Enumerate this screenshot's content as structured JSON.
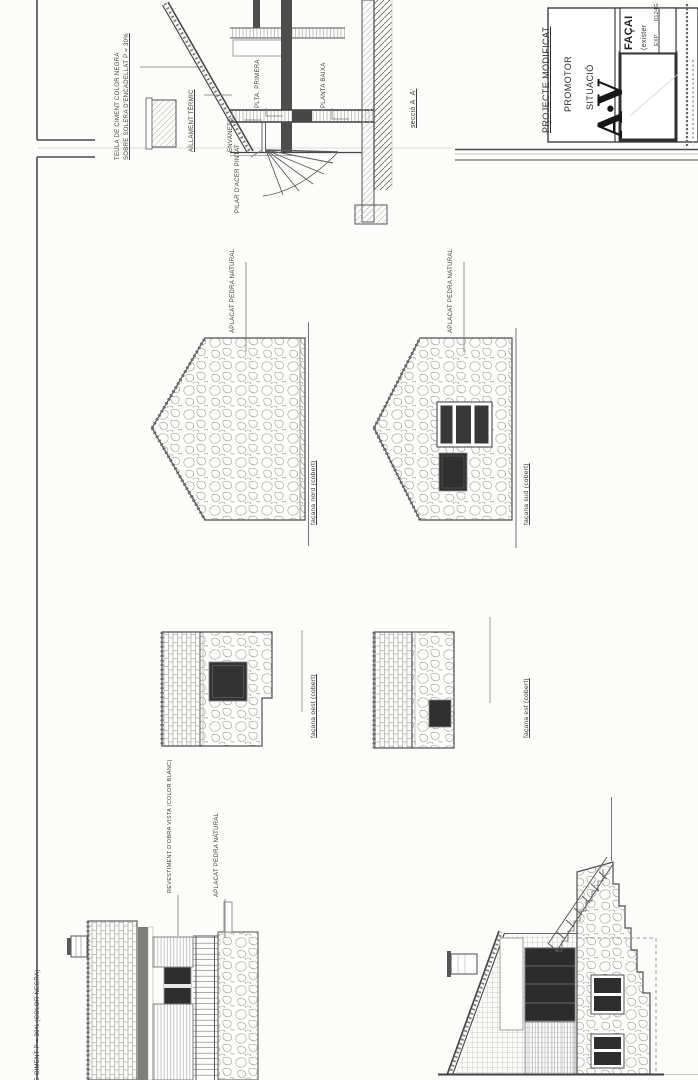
{
  "sheet": {
    "paper": "#fcfcfa",
    "ink": "#3c3c3c"
  },
  "section": {
    "title": "secció A_A'",
    "notes": {
      "teula_1": "TEULA DE CIMENT COLOR NEGRA",
      "teula_2": "SOBRE SOLERA D'ENCADELLAT P = 30%",
      "aillament": "AÏLLAMENT TÈRMIC",
      "envanets": "ENVANETS",
      "pilar": "PILAR D'ACER PINTAT",
      "plta_primera": "PLTA. PRIMERA",
      "planta_baixa": "PLANTA BAIXA"
    }
  },
  "elevations": {
    "nord": {
      "label": "façana nord (cobert)",
      "note": "APLACAT PEDRA NATURAL"
    },
    "sud": {
      "label": "façana sud (cobert)",
      "note": "APLACAT PEDRA NATURAL"
    },
    "oest": {
      "label": "façana oest (cobert)"
    },
    "est": {
      "label": "façana est (cobert)"
    },
    "oest_ampliada": {
      "note_teula": "DE CIMENT P = 30% (COLOR NEGRA)",
      "note_revestiment": "REVESTIMENT D'OBRA VISTA (COLOR BLANC)",
      "note_aplacat": "APLACAT PEDRA NATURAL"
    }
  },
  "title_block": {
    "project_row": "PROJECTE MODIFICAT",
    "promoter_row": "PROMOTOR",
    "situation_row": "SITUACIÓ",
    "logo": "A·V",
    "doc_title": "FAÇAI",
    "doc_subtitle": "(exister",
    "exp_label": "EXP",
    "exp_number": "0124G"
  }
}
